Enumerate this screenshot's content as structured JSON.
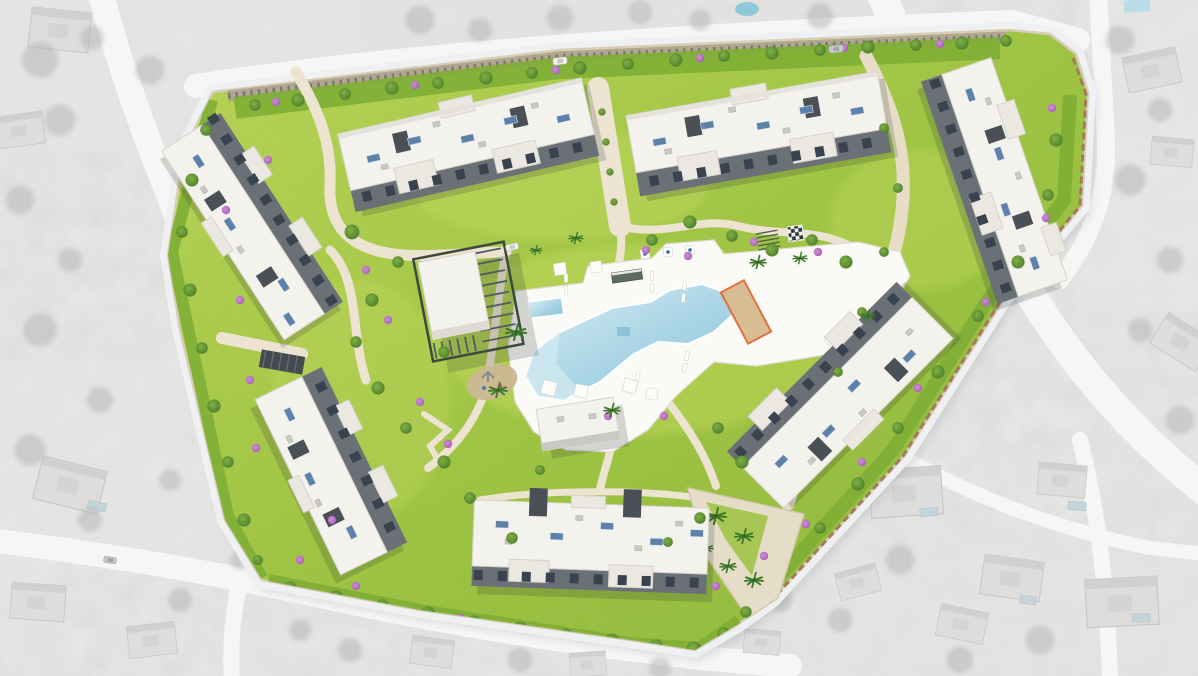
{
  "meta": {
    "title": "Residential development aerial masterplan render",
    "type": "architectural-site-plan-3d-render",
    "context": "full-color rendered development composited over grayscale aerial photograph of surrounding villas, roads and vegetation"
  },
  "scene": {
    "site": {
      "label": "residential-development-site",
      "features": [
        "apartment-block-north-west",
        "apartment-block-north-east",
        "apartment-block-east-upper",
        "apartment-block-east-lower",
        "apartment-block-west-upper",
        "apartment-block-west-lower",
        "apartment-block-south",
        "clubhouse-with-pergola",
        "gym-pavilion",
        "main-swimming-pool",
        "lap-pool",
        "pool-deck",
        "sun-loungers",
        "shade-sails",
        "pool-bar-cabana",
        "cabana-flags",
        "petanque-court",
        "giant-chess-board",
        "playground",
        "palm-lined-walkway",
        "garden-paths",
        "perimeter-parking-strip",
        "internal-street",
        "garage-ramp",
        "perimeter-planting-band"
      ],
      "surroundings": [
        "grayscale-villas",
        "grayscale-roads",
        "grayscale-tree-clusters",
        "villa-pools"
      ]
    },
    "colors": {
      "path": "#ece4d0",
      "street": "#e7ddc6",
      "photo_road": "#f6f6f5",
      "photo_base": "#ececeb",
      "photo_tree": "#b2b2b0",
      "roof": "#f3f2ed",
      "roof2": "#eae8e1",
      "roof_edge": "#d6d4cb",
      "wall": "#6b7077",
      "core": "#4a5056",
      "glass": "#39434f",
      "panel": "#5d81a8",
      "deck": "#fafaf6",
      "water_light": "#d9edf4",
      "water_mid": "#a9d4e5",
      "water_deep": "#8cc4da",
      "grass_light": "#c0d85c",
      "grass_mid": "#9ec43f",
      "grass_dark": "#7fae35",
      "sand": "#d9bd92",
      "court_border": "#e06f3c",
      "shrub_purple": "#b46cc2",
      "tree_green": "#4e7f2c",
      "tree_light": "#7fb043",
      "wall_tan": "#d8cdb8",
      "wall_brown": "#a47a58",
      "parking_strip": "#b1a691"
    }
  }
}
